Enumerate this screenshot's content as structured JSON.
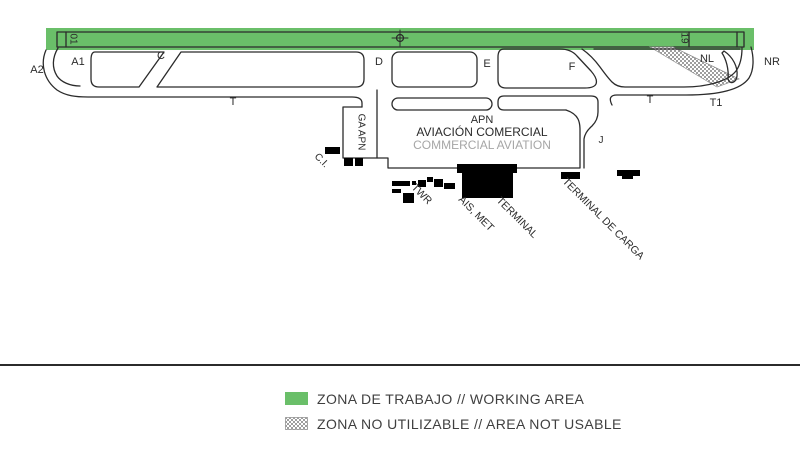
{
  "title": "Aerodrome works diagram",
  "colors": {
    "working_area_green": "#6abf69",
    "hatch_gray": "#9e9e9e",
    "ink": "#2b2b2b",
    "building_black": "#000000",
    "muted": "#a6a6a6",
    "legend_ink": "#3f3f3f"
  },
  "runway": {
    "threshold_left": "01",
    "threshold_right": "19"
  },
  "taxiways": {
    "a2": "A2",
    "a1": "A1",
    "c": "C",
    "d": "D",
    "e": "E",
    "f": "F",
    "nl": "NL",
    "nr": "NR",
    "t_west": "T",
    "t_east": "T",
    "t1": "T1",
    "j": "J"
  },
  "apron": {
    "apn": "APN",
    "aviacion_comercial": "AVIACIÓN COMERCIAL",
    "commercial_aviation": "COMMERCIAL AVIATION",
    "ga_apn": "GA APN"
  },
  "facilities": {
    "ci": "C.I.",
    "twr": "TWR",
    "ais_met": "AIS, MET",
    "terminal": "TERMINAL",
    "cargo": "TERMINAL DE CARGA"
  },
  "legend": {
    "items": [
      {
        "key": "working-area",
        "style": "green",
        "label": "ZONA DE TRABAJO // WORKING AREA"
      },
      {
        "key": "area-not-usable",
        "style": "checker",
        "label": "ZONA NO UTILIZABLE // AREA NOT USABLE"
      }
    ]
  }
}
